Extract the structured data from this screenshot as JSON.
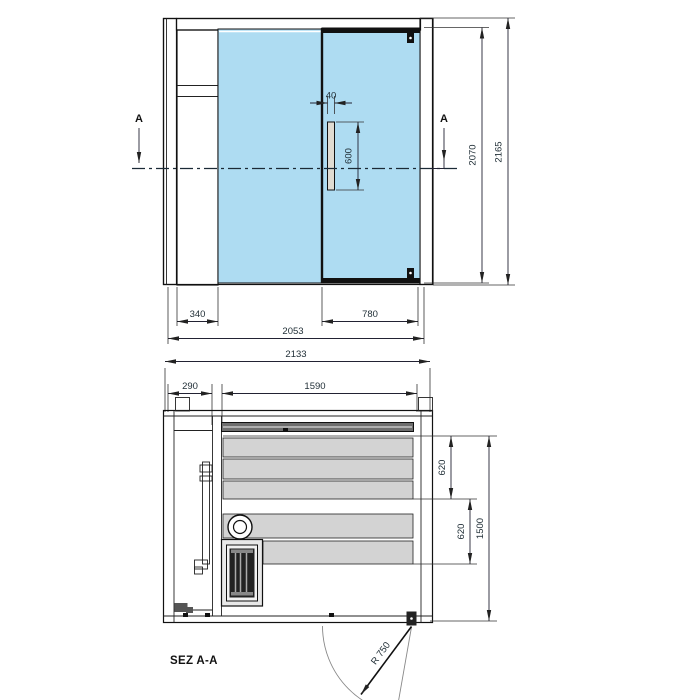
{
  "front_view": {
    "section_marker": "A",
    "dim_handle_width": "40",
    "dim_handle_length": "600",
    "dim_door_height": "2070",
    "dim_total_height": "2165",
    "dim_side_panel_width": "340",
    "dim_door_width": "780",
    "dim_total_width": "2053"
  },
  "plan_view": {
    "label": "SEZ A-A",
    "dim_total_width": "2133",
    "dim_service_gap": "290",
    "dim_interior_width": "1590",
    "dim_bench_depth_upper": "620",
    "dim_bench_depth_lower": "620",
    "dim_interior_depth": "1500",
    "dim_door_radius": "R 750"
  },
  "colors": {
    "glass": "#aedcf2",
    "frame_gray": "#c7c7c7",
    "bench_gray": "#d3d3d3",
    "line_dark": "#111111",
    "dim_text": "#223038",
    "swing_line": "#888888"
  }
}
